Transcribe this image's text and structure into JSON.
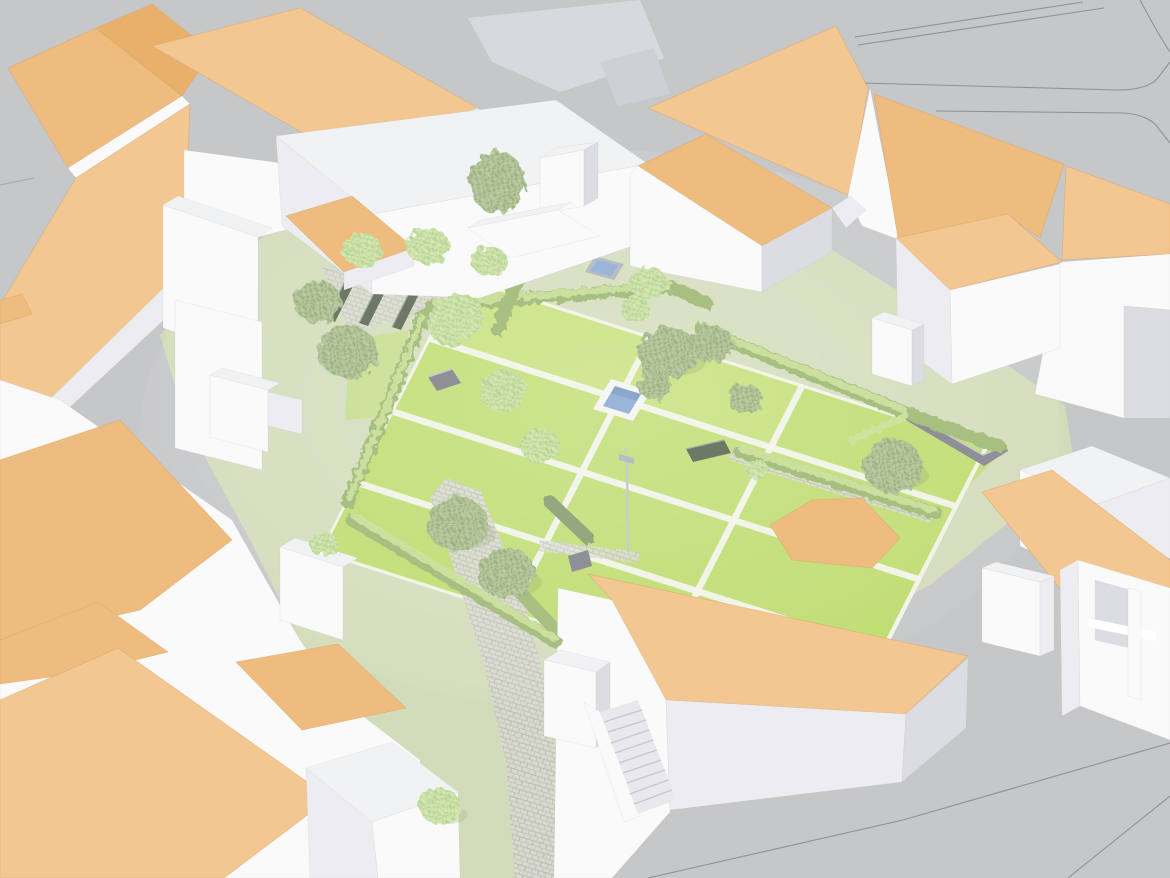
{
  "scene": {
    "kind": "3d-architectural-site-model",
    "view": "aerial axonometric render",
    "subject": "city block of white buildings with orange roofs enclosing a formal courtyard garden",
    "objects": {
      "perimeter_buildings": "white walls, orange pitched and flat roofs",
      "courtyard_garden": "lawn parcels divided by white stone paths",
      "pool": "square reflecting pool with white frame",
      "skylight": "small glazed skylight in lawn",
      "hedges": "clipped hedge rows lining paths",
      "trees": "point-cloud style trees and shrubs",
      "pergola_garden": "paved area with three garden benches",
      "garden_walls": "low gray stone walls",
      "lamppost": "single street lamp in garden",
      "stairs": "outdoor staircase beside foreground building",
      "walkway": "stone paved diagonal walkway",
      "streets": "gray streets with thin parcel lines"
    }
  },
  "colors": {
    "bg": "#c6c7c9",
    "parcel": "#919196",
    "courtyard": "#d3dcba",
    "lawn": "#bedc6e",
    "lawn_bright": "#cde381",
    "path_white": "#f3f3ec",
    "paving": "#d9d9d1",
    "paving_joint": "#bcbcb2",
    "hedge": "#a7bf80",
    "hedge_light": "#cfe3a2",
    "hedge_dark": "#93a87f",
    "tree_l1": "#d4e7b4",
    "tree_l2": "#b9d595",
    "tree_lbg": "#c8dfa6",
    "tree_s1": "#bccaa3",
    "tree_s2": "#9db284",
    "tree_sbg": "#b0c295",
    "wall_lit": "#fafafb",
    "wall_mid": "#ededf1",
    "wall_dark": "#dcdde3",
    "roof_lit": "#f3c791",
    "roof_mid": "#efbc80",
    "roof_dark": "#e9b06c",
    "roof_edge": "#d7a263",
    "white_roof": "#f1f2f4",
    "water": "#9ab5d8",
    "water_dark": "#7f9cc2",
    "pool_frame": "#f6f7f5",
    "stone_wall": "#8f9097",
    "bench": "#6e7866",
    "lamp": "#c9cbd1",
    "stairs": "#e9e9ed"
  }
}
